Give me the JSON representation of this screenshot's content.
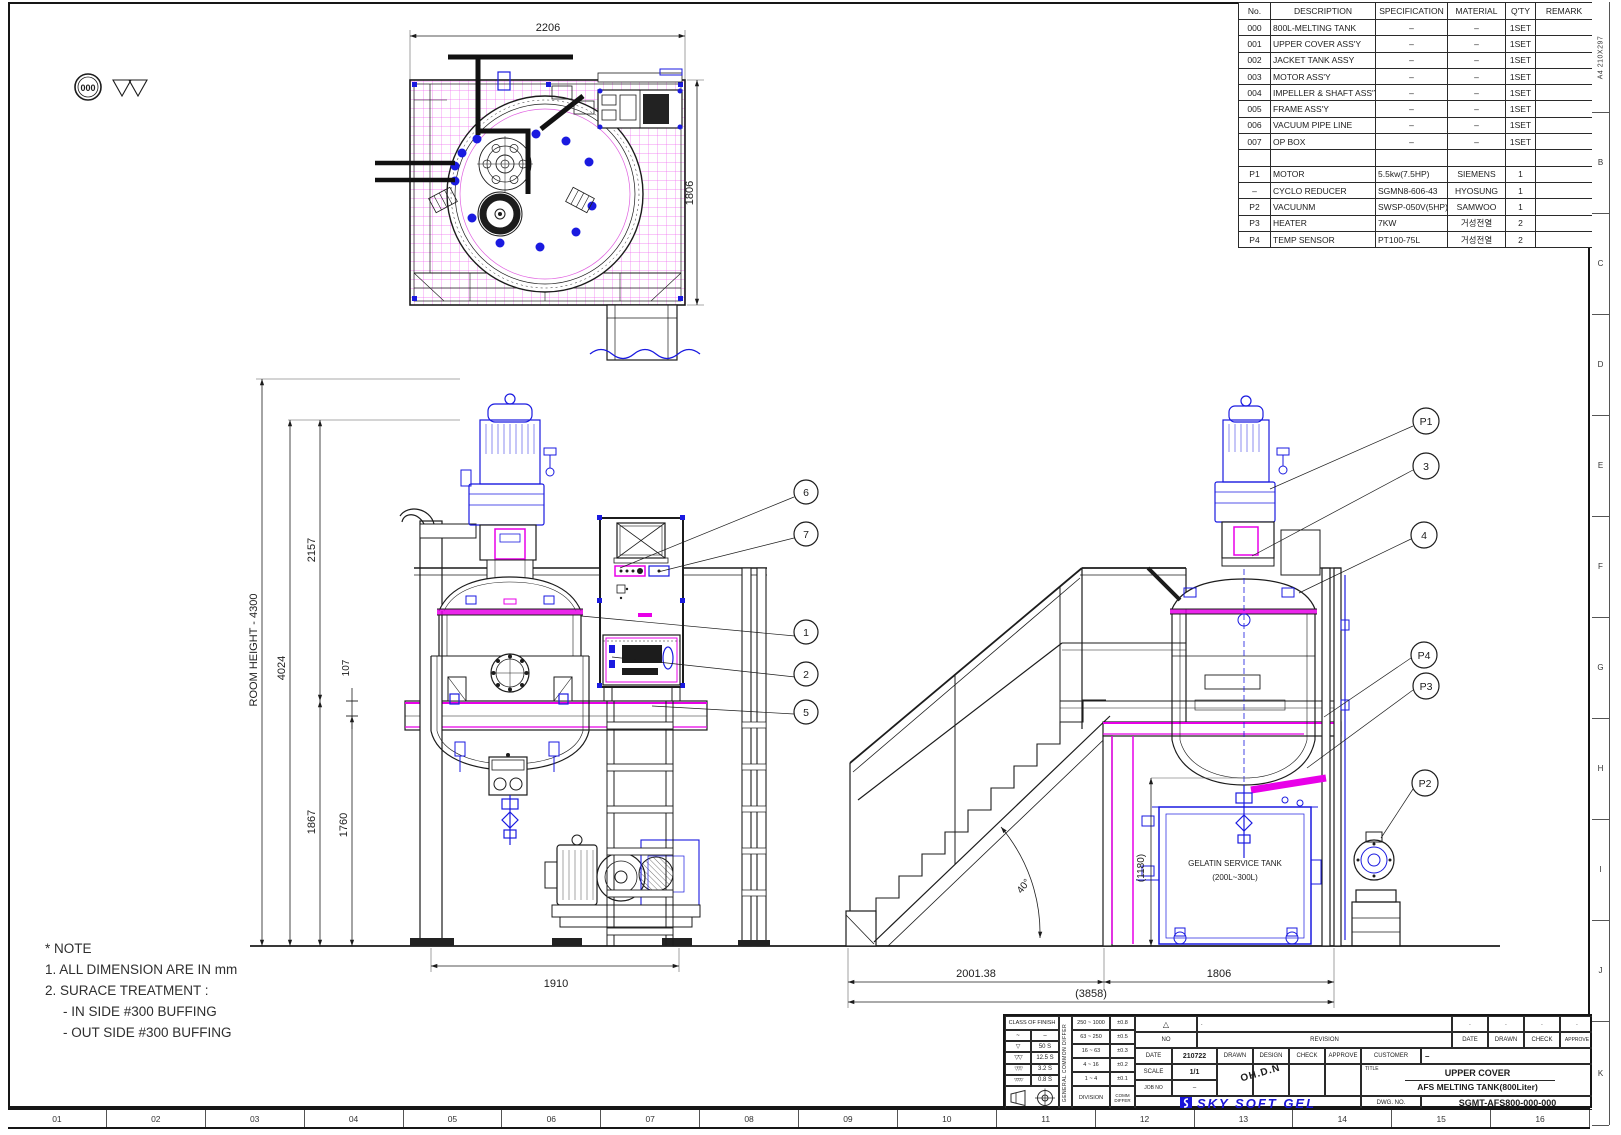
{
  "sheet": {
    "paper_note": "A4 210X297",
    "zone_letters": [
      "B",
      "C",
      "D",
      "E",
      "F",
      "G",
      "H",
      "I",
      "J",
      "K"
    ],
    "zone_numbers": [
      "01",
      "02",
      "03",
      "04",
      "05",
      "06",
      "07",
      "08",
      "09",
      "10",
      "11",
      "12",
      "13",
      "14",
      "15",
      "16"
    ]
  },
  "balloon": {
    "label": "000"
  },
  "parts_table": {
    "headers": [
      "No.",
      "DESCRIPTION",
      "SPECIFICATION",
      "MATERIAL",
      "Q'TY",
      "REMARK"
    ],
    "rows": [
      [
        "000",
        "800L-MELTING TANK",
        "–",
        "–",
        "1SET",
        ""
      ],
      [
        "001",
        "UPPER COVER ASS'Y",
        "–",
        "–",
        "1SET",
        ""
      ],
      [
        "002",
        "JACKET TANK ASSY",
        "–",
        "–",
        "1SET",
        ""
      ],
      [
        "003",
        "MOTOR ASS'Y",
        "–",
        "–",
        "1SET",
        ""
      ],
      [
        "004",
        "IMPELLER & SHAFT ASS'Y",
        "–",
        "–",
        "1SET",
        ""
      ],
      [
        "005",
        "FRAME ASS'Y",
        "–",
        "–",
        "1SET",
        ""
      ],
      [
        "006",
        "VACUUM PIPE LINE",
        "–",
        "–",
        "1SET",
        ""
      ],
      [
        "007",
        "OP BOX",
        "–",
        "–",
        "1SET",
        ""
      ],
      [
        "",
        "",
        "",
        "",
        "",
        ""
      ],
      [
        "P1",
        "MOTOR",
        "5.5kw(7.5HP)",
        "SIEMENS",
        "1",
        ""
      ],
      [
        "–",
        "CYCLO REDUCER",
        "SGMN8-606-43",
        "HYOSUNG",
        "1",
        ""
      ],
      [
        "P2",
        "VACUUNM",
        "SWSP-050V(5HP)",
        "SAMWOO",
        "1",
        ""
      ],
      [
        "P3",
        "HEATER",
        "7KW",
        "거성전열",
        "2",
        ""
      ],
      [
        "P4",
        "TEMP SENSOR",
        "PT100-75L",
        "거성전열",
        "2",
        ""
      ]
    ]
  },
  "plan_view": {
    "dim_width": "2206",
    "dim_height": "1806"
  },
  "front_view": {
    "room_height": "ROOM HEIGHT - 4300",
    "d4024": "4024",
    "d2157": "2157",
    "d107": "107",
    "d1867": "1867",
    "d1760": "1760",
    "d1910": "1910",
    "callouts": [
      "6",
      "7",
      "1",
      "2",
      "5"
    ]
  },
  "side_view": {
    "d2001": "2001.38",
    "d1806": "1806",
    "d3858": "(3858)",
    "d1180": "(1180)",
    "angle": "40°",
    "callouts": [
      "P1",
      "3",
      "4",
      "P4",
      "P3",
      "P2"
    ],
    "service_tank_line1": "GELATIN SERVICE TANK",
    "service_tank_line2": "(200L~300L)"
  },
  "notes": {
    "title": "* NOTE",
    "line1": "1. ALL DIMENSION ARE IN mm",
    "line2": "2. SURACE TREATMENT :",
    "line3": "- IN SIDE #300 BUFFING",
    "line4": "- OUT SIDE #300 BUFFING"
  },
  "title_block": {
    "finish": {
      "header": "CLASS OF FINISH",
      "sym0": "~",
      "val0": "–",
      "sym1": "▽",
      "val1": "50 S",
      "sym2": "▽▽",
      "val2": "12.5 S",
      "sym3": "▽▽▽",
      "val3": "3.2 S",
      "sym4": "▽▽▽▽",
      "val4": "0.8 S"
    },
    "tolerance": {
      "vertical_label": "GENERAL COMMON DIFFER",
      "r0a": "250 ~ 1000",
      "r0b": "±0.8",
      "r1a": "63 ~ 250",
      "r1b": "±0.5",
      "r2a": "16 ~ 63",
      "r2b": "±0.3",
      "r3a": "4 ~ 16",
      "r3b": "±0.2",
      "r4a": "1 ~ 4",
      "r4b": "±0.1",
      "division": "DIVISION",
      "comm": "COMM DIFFER"
    },
    "revision": {
      "triangle": "△",
      "dot": ".",
      "no": "NO",
      "revision": "REVISION",
      "date": "DATE",
      "drawn": "DRAWN",
      "check": "CHECK",
      "approve": "APPROVE"
    },
    "info": {
      "date_label": "DATE",
      "date_value": "210722",
      "drawn": "DRAWN",
      "design": "DESIGN",
      "check": "CHECK",
      "approve": "APPROVE",
      "customer_label": "CUSTOMER",
      "customer_value": "–",
      "scale_label": "SCALE",
      "scale_value": "1/1",
      "jobno_label": "JOB NO",
      "jobno_value": "–",
      "sign": "OH.D.N"
    },
    "title": {
      "label": "TITLE",
      "line1": "UPPER COVER",
      "line2": "AFS MELTING TANK(800Liter)"
    },
    "company": "SKY SOFT GEL",
    "dwg": {
      "label": "DWG. NO.",
      "value": "SGMT-AFS800-000-000"
    }
  }
}
